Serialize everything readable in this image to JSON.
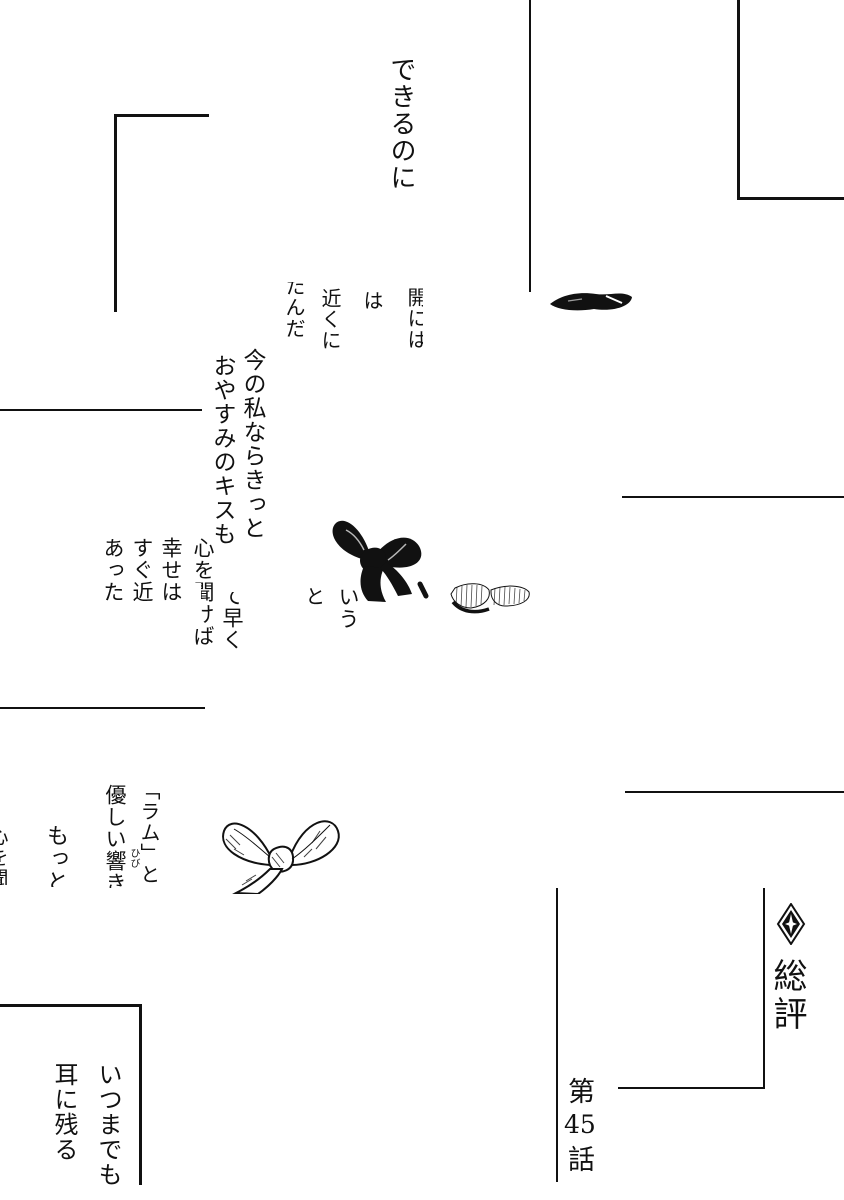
{
  "page": {
    "type": "manga-page",
    "paper_color": "#ffffff",
    "ink_color": "#111111"
  },
  "texts": {
    "dekiru": "できるのに",
    "bubble_top": {
      "c1": "開には",
      "c2": "は",
      "c3": "近くに",
      "c4": "たんだ"
    },
    "monologue": {
      "c1": "今の私ならきっと",
      "c2": "おやすみのキスも"
    },
    "block_mid": {
      "kokoro": "心を聞けば",
      "shiawase": "幸せは",
      "sugu": "すぐ近",
      "atta": "あった",
      "hayaku": "て早く",
      "to": "と",
      "iu": "いう"
    },
    "block_ram": {
      "ram": "「ラム」とい",
      "hibiki": "優しい響き",
      "furigana": "ひび",
      "motto": "もっと",
      "edge": "心を聞"
    },
    "block_bottom_left": {
      "itsumademo": "いつまでも",
      "mimi": "耳に残る"
    },
    "footer": {
      "sohyo": "総評",
      "dai": "第",
      "num": "45",
      "wa": "話"
    }
  },
  "icons": {
    "ornament": "four-point-diamond"
  }
}
